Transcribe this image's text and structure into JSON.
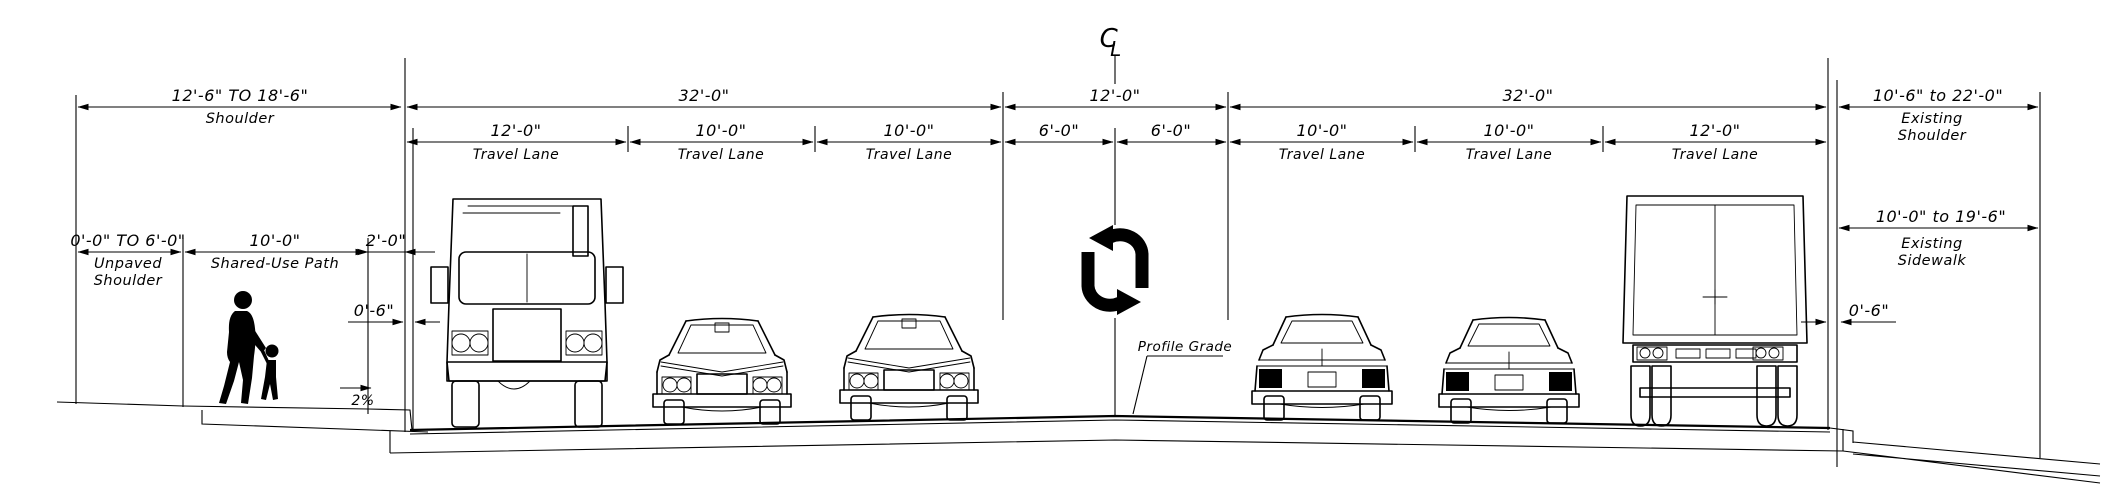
{
  "diagram": {
    "centerline": {
      "letter_c": "C",
      "letter_l": "L"
    },
    "profile_grade_label": "Profile Grade",
    "slope_label": "2%",
    "overall_dims": {
      "left_shoulder_value": "12'-6\" TO 18'-6\"",
      "left_shoulder_label": "Shoulder",
      "left_roadway_value": "32'-0\"",
      "median_value": "12'-0\"",
      "right_roadway_value": "32'-0\"",
      "right_shoulder_value": "10'-6\" to 22'-0\"",
      "right_shoulder_label_lines": [
        "Existing",
        "Shoulder"
      ]
    },
    "lanes": [
      {
        "width": "12'-0\"",
        "label": "Travel Lane"
      },
      {
        "width": "10'-0\"",
        "label": "Travel Lane"
      },
      {
        "width": "10'-0\"",
        "label": "Travel Lane"
      },
      {
        "width": "10'-0\"",
        "label": "Travel Lane"
      },
      {
        "width": "10'-0\"",
        "label": "Travel Lane"
      },
      {
        "width": "12'-0\"",
        "label": "Travel Lane"
      }
    ],
    "median_halves": [
      "6'-0\"",
      "6'-0\""
    ],
    "left_side": {
      "unpaved_shoulder_value": "0'-0\" TO 6'-0\"",
      "unpaved_shoulder_label_lines": [
        "Unpaved",
        "Shoulder"
      ],
      "shared_use_path_value": "10'-0\"",
      "shared_use_path_label": "Shared-Use Path",
      "buffer_value": "2'-0\"",
      "curb_value": "0'-6\""
    },
    "right_side": {
      "existing_sidewalk_value": "10'-0\" to 19'-6\"",
      "existing_sidewalk_label_lines": [
        "Existing",
        "Sidewalk"
      ],
      "curb_value": "0'-6\""
    }
  }
}
